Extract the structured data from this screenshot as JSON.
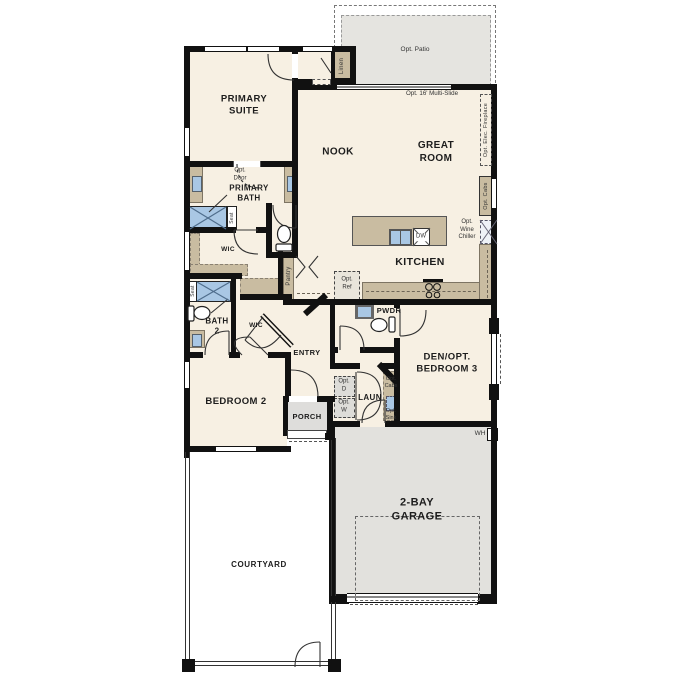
{
  "plan": {
    "rooms": {
      "primary_suite": "PRIMARY\nSUITE",
      "nook": "NOOK",
      "great_room": "GREAT\nROOM",
      "kitchen": "KITCHEN",
      "primary_bath": "PRIMARY\nBATH",
      "wic_primary": "WIC",
      "wic_2": "WIC",
      "bath_2": "BATH\n2",
      "entry": "ENTRY",
      "bedroom_2": "BEDROOM 2",
      "porch": "PORCH",
      "pwdr": "PWDR",
      "laundry": "LAUN",
      "den": "DEN/OPT.\nBEDROOM 3",
      "garage": "2-BAY\nGARAGE",
      "courtyard": "COURTYARD",
      "patio": "Opt. Patio"
    },
    "annotations": {
      "linen": "Linen",
      "multi_slide": "Opt. 16' Multi-Slide",
      "elec_fireplace": "Opt. Elec. Fireplace",
      "opt_cabs_kitchen": "Opt. Cabs",
      "wine_chiller": "Opt.\nWine\nChiller",
      "opt_ref": "Opt.\nRef",
      "opt_door": "Opt.\nDoor",
      "seat_primary": "Seat",
      "seat_bath2": "Seat",
      "pantry": "Pantry",
      "dw": "DW",
      "opt_d": "Opt.\nD",
      "opt_w": "Opt.\nW",
      "opt_cabs_laundry": "Opt.\nCabs",
      "opt_sink": "Opt.\nSink",
      "wh": "WH"
    },
    "colors": {
      "wall": "#111111",
      "floor": "#f7f0e3",
      "cabinet_tan": "#c9bca1",
      "fixture_blue": "#a9c7e4",
      "exterior_gray": "#e3e2de",
      "dash_gray": "#555555"
    }
  }
}
